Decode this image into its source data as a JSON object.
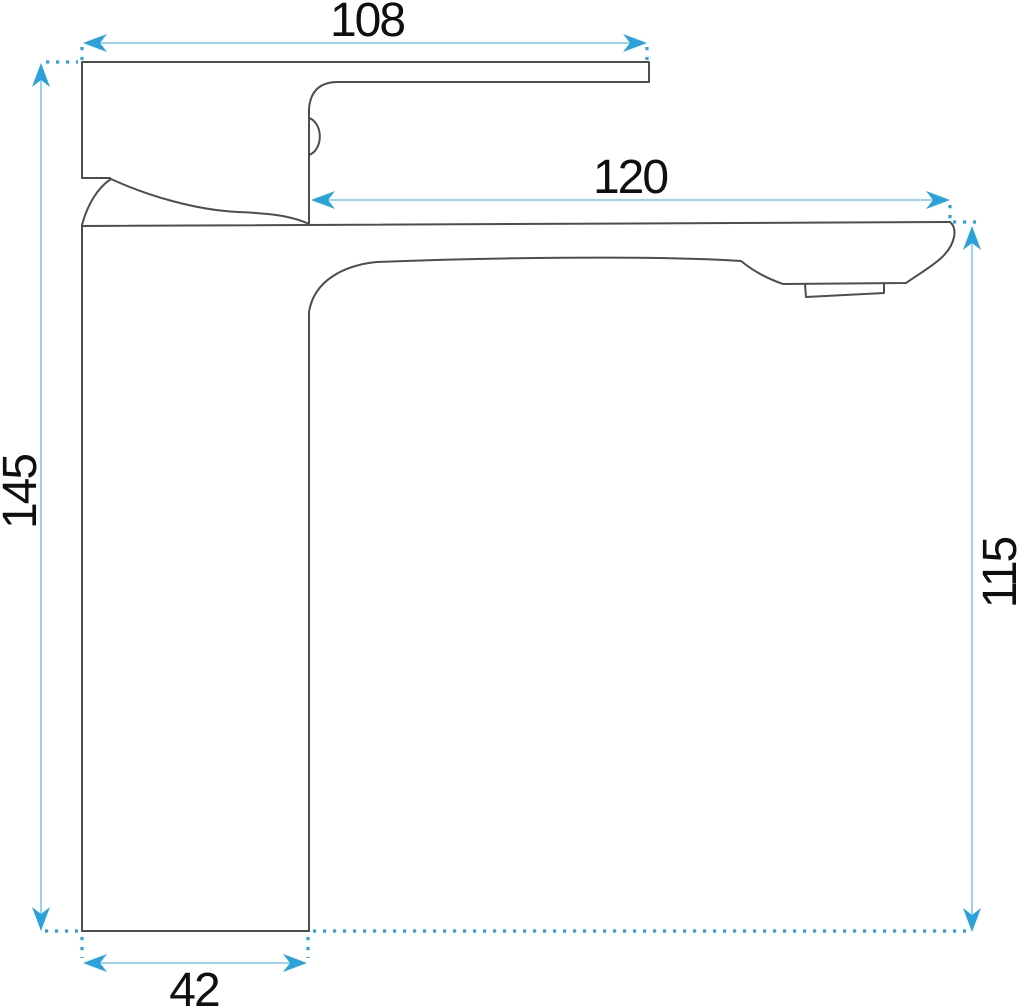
{
  "drawing": {
    "kind": "dimensioned technical line drawing",
    "dimensions": {
      "handle_width": {
        "name": "handle / top width",
        "value": "108"
      },
      "spout_reach": {
        "name": "spout reach",
        "value": "120"
      },
      "total_height": {
        "name": "total height",
        "value": "145"
      },
      "spout_height": {
        "name": "spout outlet height",
        "value": "115"
      },
      "base_width": {
        "name": "base width",
        "value": "42"
      }
    },
    "colors": {
      "background": "#ffffff",
      "outline": "#4d4d4d",
      "dimension_line": "#8ecfeb",
      "dimension_accent": "#2ba3da",
      "text": "#0f0f0f"
    }
  }
}
